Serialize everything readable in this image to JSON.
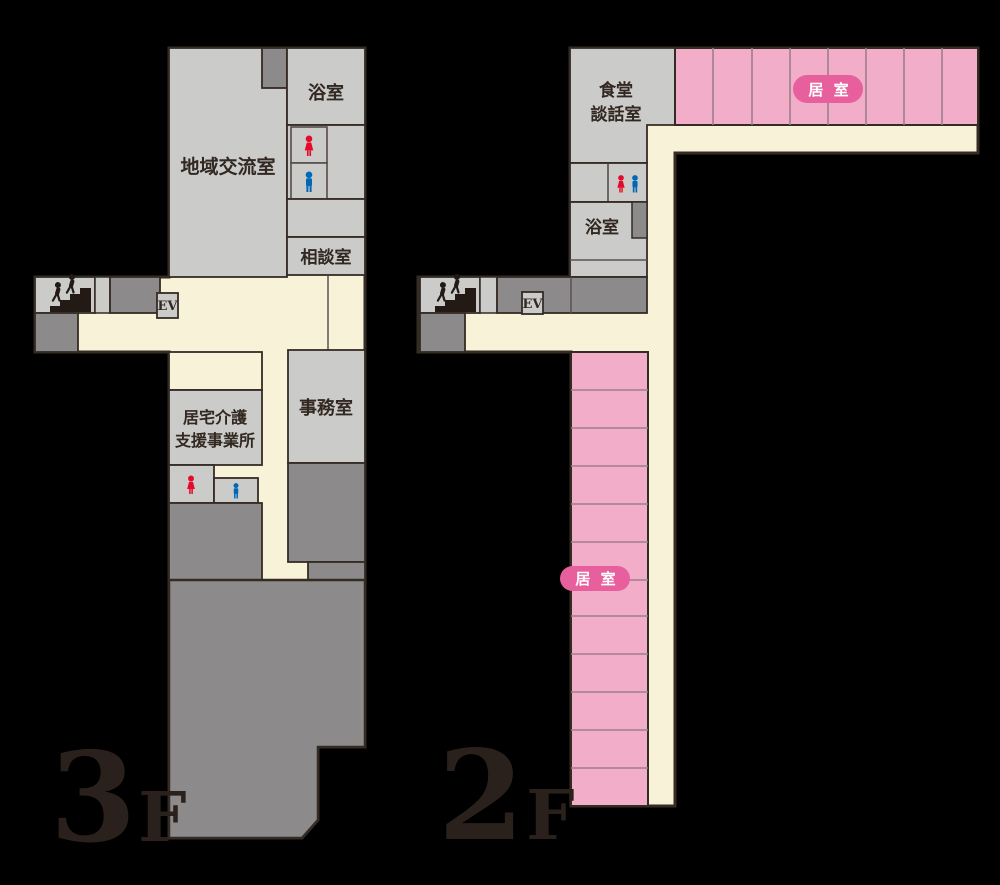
{
  "title": "facility-floor-map",
  "colors": {
    "background": "#000000",
    "room_light_gray": "#cbcbca",
    "room_dark_gray": "#8c8a8a",
    "corridor_cream": "#f8f2d9",
    "living_room_pink": "#f2adc9",
    "badge_pink": "#e7609d",
    "outline": "#352b25",
    "toilet_woman_red": "#e50a2b",
    "toilet_man_blue": "#0068b5"
  },
  "floors": {
    "f3": {
      "number": "3",
      "suffix": "F",
      "rooms": {
        "community": "地域交流室",
        "bath": "浴室",
        "consult": "相談室",
        "homecare1": "居宅介護",
        "homecare2": "支援事業所",
        "office": "事務室",
        "elevator": "EV"
      }
    },
    "f2": {
      "number": "2",
      "suffix": "F",
      "rooms": {
        "dining1": "食堂",
        "dining2": "談話室",
        "bath": "浴室",
        "elevator": "EV",
        "living_badge_top": "居 室",
        "living_badge_side": "居 室"
      }
    }
  },
  "icons": {
    "stairs": "stairs-icon",
    "toilet_woman": "woman-icon",
    "toilet_man": "man-icon"
  }
}
